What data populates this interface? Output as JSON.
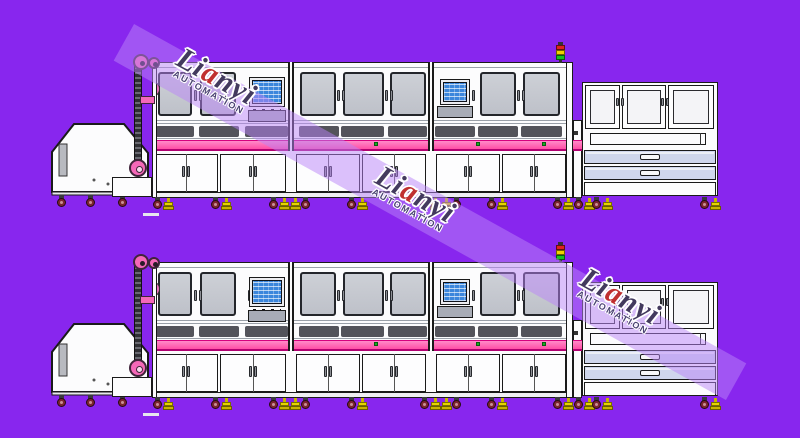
{
  "title": "automation-line-drawing",
  "colors": {
    "background": "#8826EE",
    "machine_white": "#FCFCFD",
    "outline": "#1a1a1a",
    "glass_top": "#CDD0D6",
    "glass_bottom": "#BEC1C9",
    "vent": "#53535A",
    "pink_top": "#FF8AC8",
    "pink_bottom": "#FF4EA6",
    "pink_border_top": "#D6017E",
    "pink_border_bottom": "#B10070",
    "pulley_pink": "#F468B8",
    "drawer": "#CFD6EC",
    "screen_blue": "#3B86DC",
    "wheel_maroon": "#7E2430",
    "foot_yellow": "#E8D400",
    "foot_yellow_dark": "#C8B400",
    "tower_red": "#E02020",
    "tower_yellow": "#F0D000",
    "tower_green": "#18C020",
    "green_dot": "#18B020",
    "stripe": "rgba(186,132,248,0.5)",
    "logo_text": "#433a5e",
    "logo_accent": "#C03030",
    "logo_sub": "#4a4272",
    "dash": "#E6E6EE"
  },
  "watermark": {
    "logo": "Lianyi",
    "sub": "AUTOMATION",
    "angle_deg": 29,
    "stripe": {
      "cx": 430,
      "cy": 212,
      "len": 700,
      "wid": 42
    },
    "logos": [
      {
        "x": 228,
        "y": 100
      },
      {
        "x": 427,
        "y": 218
      },
      {
        "x": 632,
        "y": 320
      }
    ]
  },
  "lines": [
    {
      "top": 0
    },
    {
      "top": 200
    }
  ],
  "geometry": {
    "hopper": {
      "x": 50,
      "y": 120,
      "w": 100,
      "h": 78,
      "poly": "2,32 24,4 74,4 98,33 98,72 2,72",
      "base": {
        "x": 2,
        "y": 72,
        "w": 96,
        "h": 3
      },
      "slot": {
        "x": 9,
        "y": 24,
        "w": 8,
        "h": 32
      },
      "specks": [
        [
          44,
          60
        ],
        [
          58,
          64
        ]
      ],
      "casters": [
        57,
        86,
        118
      ]
    },
    "table": {
      "x": 112,
      "y": 177,
      "w": 40,
      "h": 20
    },
    "elevator": {
      "chain": {
        "x": 134,
        "y": 66,
        "w": 8,
        "h": 102
      },
      "pulley1": {
        "cx": 141,
        "cy": 62,
        "r": 8
      },
      "pulley2": {
        "cx": 154,
        "cy": 63,
        "r": 6
      },
      "sprocket": {
        "cx": 138,
        "cy": 168,
        "r": 9
      },
      "bar": {
        "x": 140,
        "y": 96,
        "w": 15,
        "h": 8
      }
    },
    "tower": {
      "x": 556,
      "y": 42
    },
    "main": {
      "x": 152,
      "y": 62,
      "w": 421,
      "h": 136,
      "hairlines": [
        67,
        120,
        123,
        138
      ],
      "winY": 72,
      "winH": 44,
      "windows": [
        {
          "x": 158,
          "w": 34
        },
        {
          "x": 200,
          "w": 36
        },
        {
          "x": 300,
          "w": 36
        },
        {
          "x": 343,
          "w": 41
        },
        {
          "x": 390,
          "w": 36
        },
        {
          "x": 480,
          "w": 36
        },
        {
          "x": 523,
          "w": 37
        }
      ],
      "porthole": {
        "x": 152,
        "y": 81,
        "w": 8,
        "h": 16
      },
      "handlePairs": [
        194,
        337,
        385,
        517
      ],
      "handleSingles": [
        248,
        472
      ],
      "monitors": [
        {
          "sx": 252,
          "sy": 80,
          "sw": 30,
          "sh": 24,
          "tx": 248,
          "ty": 110,
          "tw": 38,
          "th": 12
        },
        {
          "sx": 443,
          "sy": 82,
          "sw": 24,
          "sh": 20,
          "tx": 437,
          "ty": 106,
          "tw": 36,
          "th": 12
        }
      ],
      "ventY": 126,
      "ventH": 11,
      "vents": [
        {
          "x": 156,
          "w": 38
        },
        {
          "x": 199,
          "w": 40
        },
        {
          "x": 245,
          "w": 43
        },
        {
          "x": 299,
          "w": 40
        },
        {
          "x": 341,
          "w": 43
        },
        {
          "x": 388,
          "w": 39
        },
        {
          "x": 435,
          "w": 40
        },
        {
          "x": 478,
          "w": 40
        },
        {
          "x": 521,
          "w": 41
        }
      ],
      "pink": {
        "y": 140,
        "h": 11
      },
      "greenDots": [
        374,
        476,
        542
      ],
      "dividers": [
        288,
        428
      ],
      "lowerY": 154,
      "lowerH": 38,
      "cabinets": [
        {
          "x": 154,
          "w": 64
        },
        {
          "x": 220,
          "w": 66
        },
        {
          "x": 296,
          "w": 64
        },
        {
          "x": 362,
          "w": 64
        },
        {
          "x": 436,
          "w": 64
        },
        {
          "x": 502,
          "w": 64
        }
      ],
      "frame": {
        "y": 192,
        "h": 6
      }
    },
    "station": {
      "x": 582,
      "y": 82,
      "w": 136,
      "h": 114,
      "doorY": 85,
      "doorH": 44,
      "doors": [
        {
          "x": 585,
          "w": 35
        },
        {
          "x": 622,
          "w": 44
        },
        {
          "x": 668,
          "w": 46
        }
      ],
      "handles": [
        619,
        664
      ],
      "bandY": 129,
      "bandH": 19,
      "slot": {
        "x": 590,
        "y": 133,
        "w": 116,
        "h": 12
      },
      "slotDiv": 700,
      "sq": {
        "x": 574,
        "y": 131
      },
      "drawerYs": [
        150,
        166
      ],
      "drawerH": 14,
      "drawerX": 584,
      "drawerW": 132,
      "handle": {
        "x": 640,
        "w": 20,
        "h": 6
      },
      "bottom": {
        "y": 182,
        "h": 14
      },
      "connector": {
        "x": 573,
        "y": 120,
        "w": 9,
        "h": 78
      }
    },
    "feetY": 197,
    "feet": [
      {
        "x": 153,
        "t": "wf"
      },
      {
        "x": 211,
        "t": "wf"
      },
      {
        "x": 269,
        "t": "wffw"
      },
      {
        "x": 347,
        "t": "wf"
      },
      {
        "x": 420,
        "t": "wffw"
      },
      {
        "x": 487,
        "t": "wf"
      },
      {
        "x": 553,
        "t": "wfwf"
      },
      {
        "x": 592,
        "t": "wf"
      },
      {
        "x": 700,
        "t": "wf"
      }
    ],
    "dash": {
      "x": 143,
      "y": 213,
      "w": 16,
      "h": 3
    }
  }
}
